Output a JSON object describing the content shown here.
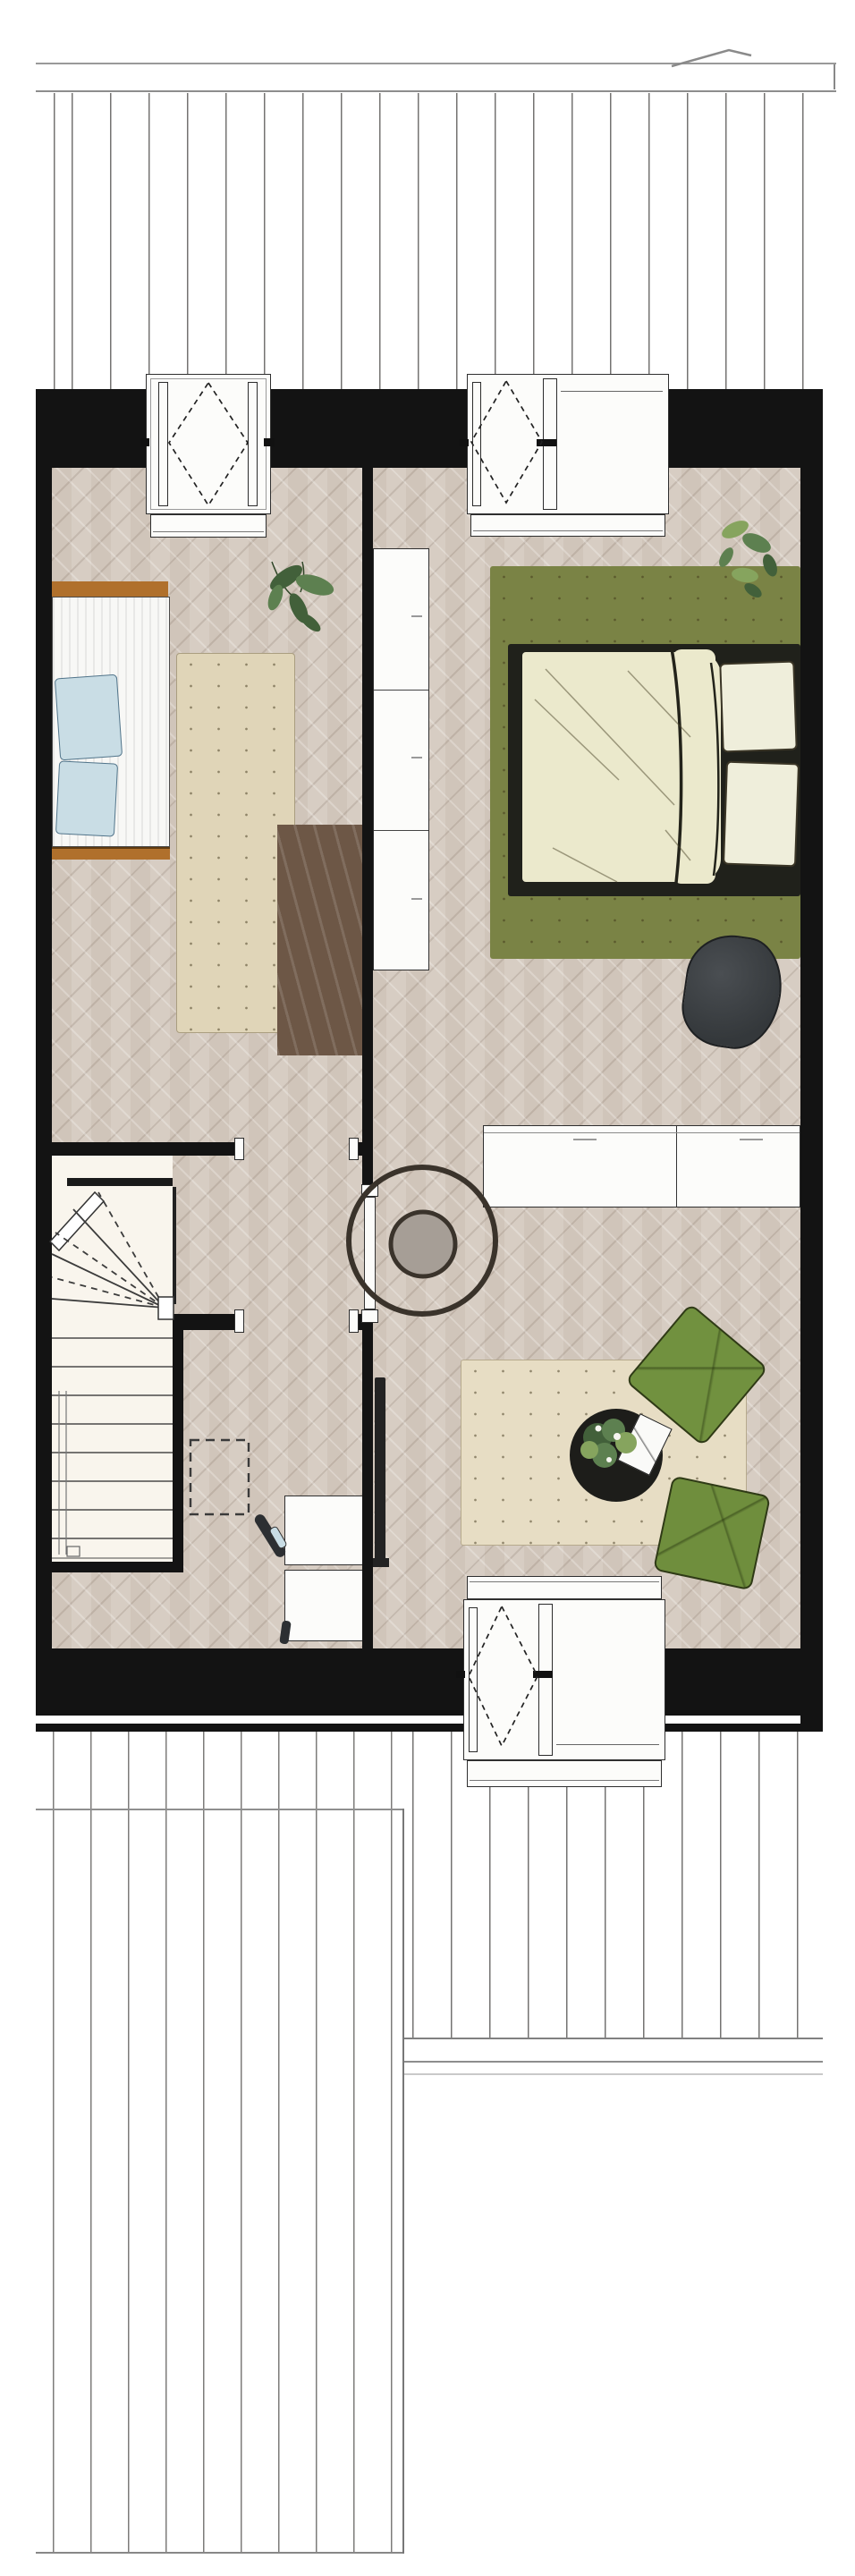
{
  "document": {
    "kind": "architectural floor plan, top-down sketch style, no text labels",
    "rooms": [
      {
        "name": "bedroom-left",
        "furniture": [
          "single bed with wood head/foot board and blue pillows",
          "beige rug",
          "dark brown rug",
          "plant"
        ]
      },
      {
        "name": "bedroom-right",
        "furniture": [
          "double bed on olive green rug",
          "pothos plant",
          "wardrobe",
          "white sideboard",
          "beanbag"
        ]
      },
      {
        "name": "hall-landing",
        "furniture": [
          "round ring rug",
          "round grey side table",
          "open door"
        ]
      },
      {
        "name": "stairwell",
        "furniture": [
          "winder staircase with handrail"
        ]
      },
      {
        "name": "study-corner",
        "furniture": [
          "dashed floor outline",
          "two white desks",
          "chair with blue seat"
        ]
      },
      {
        "name": "lounge-corner",
        "furniture": [
          "wall tv panel",
          "cream rug",
          "two green floor cushions",
          "round black coffee table with plant and white tray"
        ]
      }
    ],
    "windows": [
      "top-left dormer tilt window",
      "top-right dormer window with fixed pane",
      "bottom dormer window"
    ],
    "roof": [
      "top roof plank area with fascia band and pen mark",
      "bottom-left roof plank area",
      "bottom-right roof plank area"
    ]
  },
  "colors": {
    "floor": "#d5cabf",
    "wall": "#131313",
    "stair_bg": "#f9f5ed",
    "white": "#fcfcfa",
    "rug_green": "#7a8345",
    "rug_cream": "#e7ddc4",
    "rug_beige": "#e0d5b8",
    "rug_brown": "#6d5746",
    "bed_frame": "#20211b",
    "duvet": "#ebe9cc",
    "pillow_cream": "#efeedb",
    "bed_white": "#f8f8f6",
    "pillow_blue": "#c9dde5",
    "wood": "#b0702c",
    "beanbag": "#3c4043",
    "cushion_a": "#71913f",
    "cushion_b": "#6f8e3d",
    "table_black": "#1d1d1a",
    "tv_dark": "#232323",
    "ring_brown": "#3a332b",
    "disc_grey": "#a69e96",
    "plant_dark": "#42603a",
    "plant_mid": "#5d8050",
    "plant_light": "#86a45e",
    "chair_dark": "#2c2f32",
    "stripe_dark": "#1a1a1a"
  }
}
